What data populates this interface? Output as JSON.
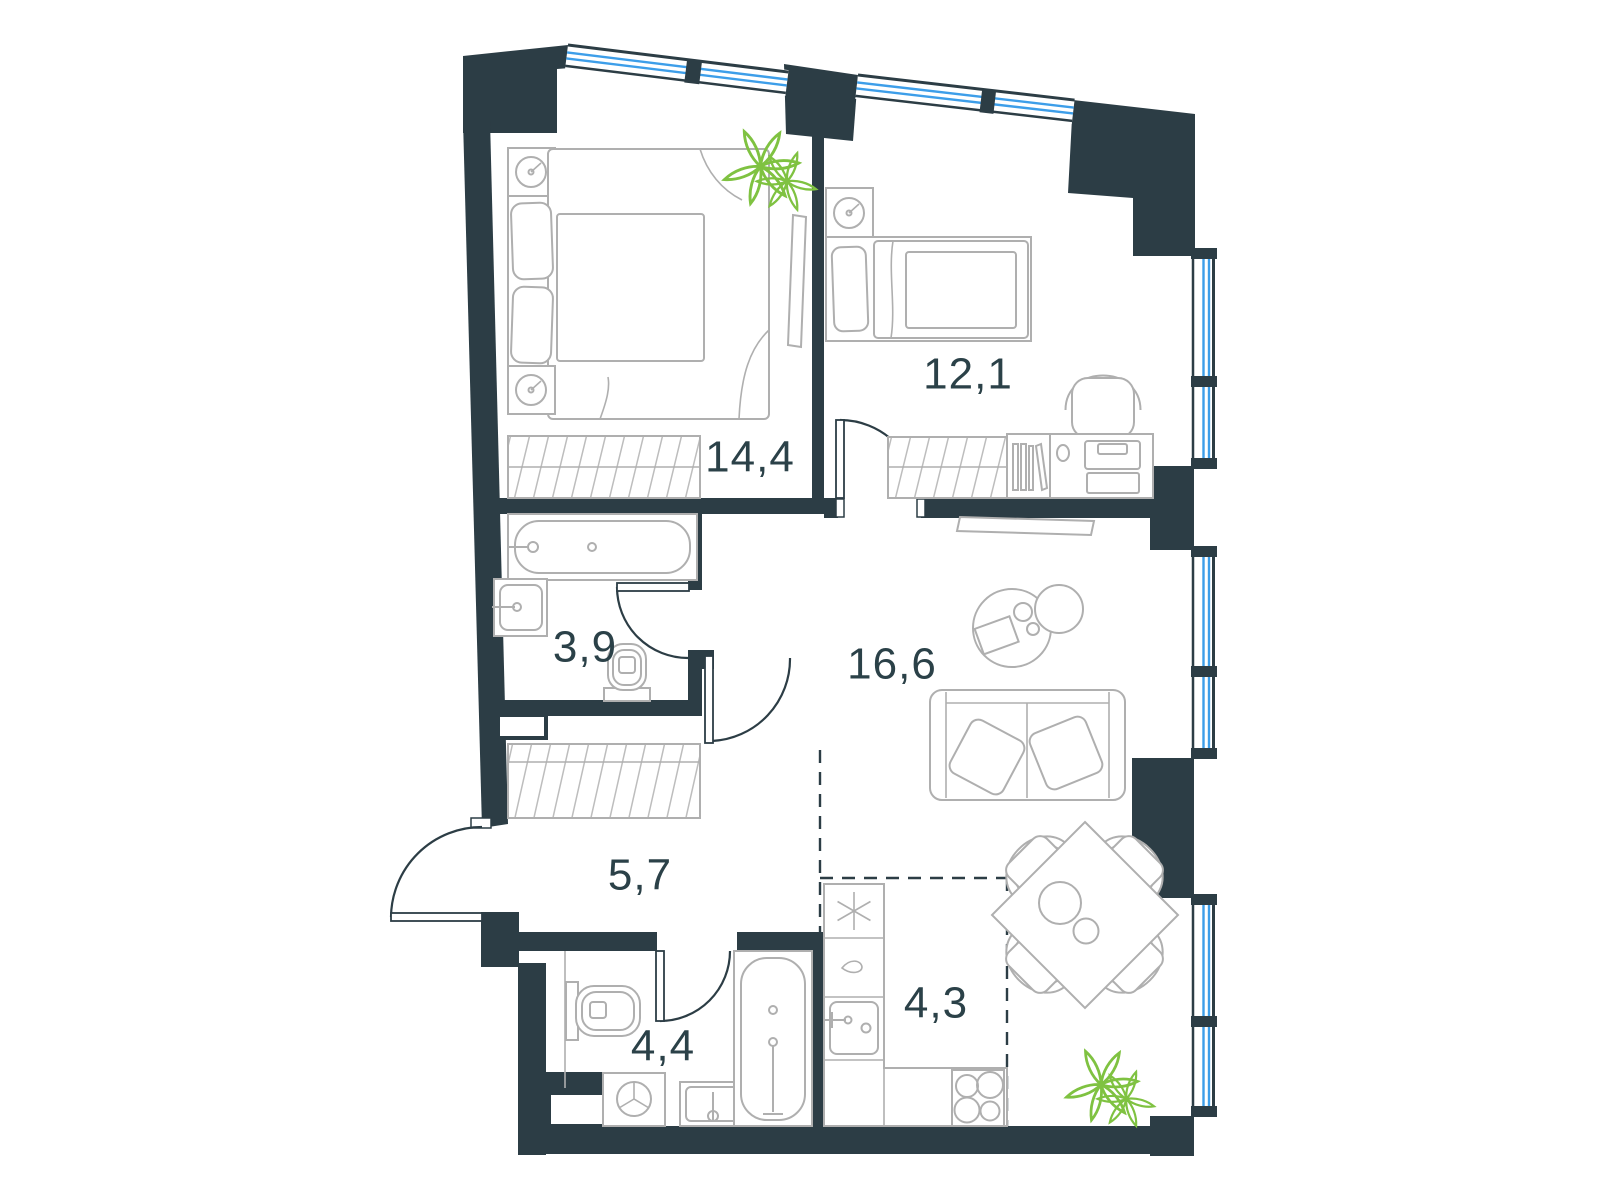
{
  "floor_plan": {
    "rooms": [
      {
        "name": "bedroom-primary",
        "area_label": "14,4"
      },
      {
        "name": "bedroom-secondary",
        "area_label": "12,1"
      },
      {
        "name": "bathroom-small",
        "area_label": "3,9"
      },
      {
        "name": "living-room",
        "area_label": "16,6"
      },
      {
        "name": "hallway",
        "area_label": "5,7"
      },
      {
        "name": "bathroom-main",
        "area_label": "4,4"
      },
      {
        "name": "kitchen",
        "area_label": "4,3"
      }
    ],
    "colors": {
      "wall": "#2C3D45",
      "window_glass": "#3D9EE9",
      "furniture_outline": "#AFAFAF",
      "plant": "#7FC241",
      "label_text": "#2B4148",
      "background": "#FFFFFF"
    }
  }
}
